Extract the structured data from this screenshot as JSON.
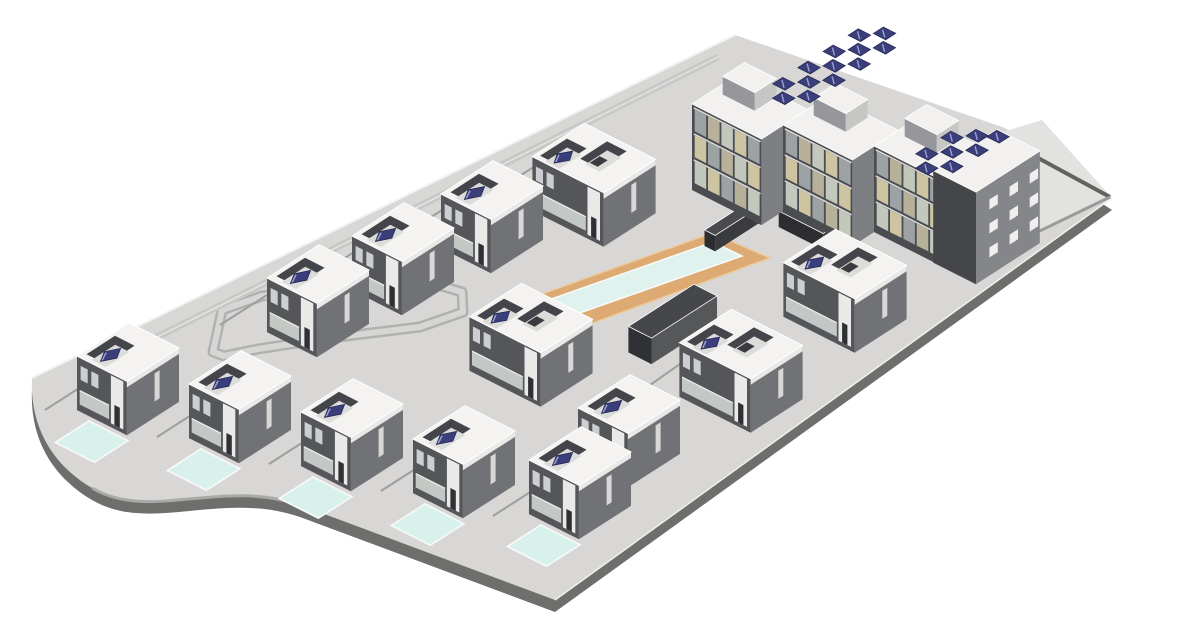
{
  "meta": {
    "title": "Axonometric BIM rendering of a residential development: rows of two-storey villas with private pools and rooftop solar terraces, a central communal swimming pool with timber deck, and a three-storey apartment complex with rooftop photovoltaic arrays",
    "width": 1200,
    "height": 640
  },
  "iso": {
    "u": [
      0.84,
      -0.54
    ],
    "v": [
      0.89,
      0.45
    ]
  },
  "palette": {
    "background": "#ffffff",
    "slabTop": "#d8d7d6",
    "slabShadow": "#6e6e6d",
    "slabEdgeLight": "#f2f2f1",
    "plaza": "#e2e2e1",
    "plazaParapetDark": "#62625f",
    "plazaParapetLight": "#9a9a99",
    "road": "#b1b1b0",
    "roadInner": "#d6d6d5",
    "curb": "#a9a9a8",
    "pathLight": "#c8c8c7",
    "pathCenter": "#e4e4e3",
    "lotLine": "#9e9e9d",
    "villaRoof": "#f4f3f1",
    "villaSW": "#55565a",
    "villaSE": "#717276",
    "villaWhite": "#eae9e7",
    "villaDoor": "#2e3034",
    "windowLight": "#ccced1",
    "balconyGlass": "#c3c8c5",
    "railLight": "#f0f0ee",
    "terraceWall": "#44454a",
    "terraceFloor": "#dcdcda",
    "terraceSlit": "#3a3b3f",
    "solar": "#3a3e7a",
    "solarEdge": "#242650",
    "solarStreak": "#9ba1d2",
    "deck": "#dcaa72",
    "deckEdge": "#ecca9b",
    "water": "#e0f2ee",
    "poolEdge": "#fafaf9",
    "frontPool": "#d9f1ec",
    "aptRoof": "#f2f1ef",
    "aptFrame": "#4b4c50",
    "aptSE": "#7e7f83",
    "pentSW": "#96979a",
    "pentSE": "#c6c6c4",
    "towerSW": "#45464a",
    "towerSE": "#85868a",
    "floorLine": "#dadad8",
    "parapetLine": "#c9c9c7",
    "courtTop": "#4a4b4e",
    "courtSW": "#2c2d30",
    "courtSE": "#3a3b3e",
    "phTop": "#46474a",
    "phSW": "#303134",
    "phSE": "#565759",
    "balconyCells": [
      "#c3c8bd",
      "#cdc5a2",
      "#9da3a5",
      "#b7b09a"
    ]
  },
  "site": {
    "outline": "M32,378 L735,35 L1005,128 L1112,198 L555,600 L300,505 C220,478 150,522 92,488 C48,462 30,422 32,378 Z",
    "shadow_dy": 12,
    "edge_highlight": [
      32,
      378,
      735,
      35
    ],
    "se_lip": [
      555,
      600,
      1112,
      198
    ]
  },
  "plaza": {
    "poly": [
      [
        950,
        148
      ],
      [
        1042,
        120
      ],
      [
        1112,
        198
      ],
      [
        1015,
        245
      ]
    ],
    "parapet_dark": [
      [
        1005,
        140
      ],
      [
        1110,
        197
      ]
    ],
    "parapet_light": [
      [
        1110,
        197
      ],
      [
        1015,
        243
      ]
    ]
  },
  "roads": {
    "loop": [
      [
        213,
        352
      ],
      [
        222,
        310
      ],
      [
        262,
        296
      ],
      [
        330,
        289
      ],
      [
        428,
        282
      ],
      [
        462,
        292
      ],
      [
        463,
        312
      ],
      [
        420,
        327
      ],
      [
        330,
        338
      ],
      [
        258,
        349
      ],
      [
        224,
        356
      ]
    ],
    "top_path": [
      95,
      368,
      718,
      57
    ],
    "curve_curb": "M300,505 C220,478 150,522 92,488",
    "dividers": [
      [
        140,
        349,
        45,
        410
      ],
      [
        252,
        376,
        157,
        437
      ],
      [
        364,
        403,
        269,
        464
      ],
      [
        476,
        430,
        381,
        491
      ],
      [
        588,
        455,
        493,
        516
      ],
      [
        275,
        290,
        220,
        325
      ],
      [
        362,
        247,
        307,
        282
      ],
      [
        450,
        205,
        395,
        240
      ],
      [
        540,
        163,
        485,
        198
      ],
      [
        598,
        418,
        545,
        452
      ],
      [
        700,
        350,
        650,
        385
      ]
    ]
  },
  "pool": {
    "deck": [
      [
        475,
        318
      ],
      [
        712,
        233
      ],
      [
        770,
        258
      ],
      [
        533,
        345
      ]
    ],
    "water": [
      [
        503,
        316
      ],
      [
        713,
        242
      ],
      [
        742,
        256
      ],
      [
        531,
        330
      ]
    ]
  },
  "pool_house": {
    "o": [
      676,
      334
    ],
    "u": [
      -44,
      34
    ],
    "v": [
      -12,
      14
    ],
    "h": 26
  },
  "court_walls": [
    {
      "o": [
        756,
        219
      ],
      "u": [
        -55,
        55
      ],
      "v": [
        -6,
        6
      ],
      "h": 16
    },
    {
      "o": [
        806,
        235
      ],
      "u": [
        -6,
        6
      ],
      "v": [
        -25,
        25
      ],
      "h": 16
    }
  ],
  "apartments": {
    "modules": [
      [
        692,
        190
      ],
      [
        783,
        211
      ],
      [
        874,
        232
      ]
    ],
    "mod_u": [
      0,
      55
    ],
    "mod_v": [
      0,
      78
    ],
    "mod_h": 86,
    "penthouse": {
      "u": [
        26,
        52
      ],
      "v": [
        10,
        46
      ],
      "z": [
        86,
        104
      ]
    },
    "balcony_floors": [
      [
        8,
        30
      ],
      [
        34,
        56
      ],
      [
        60,
        82
      ]
    ],
    "balcony_bays": {
      "start": 3,
      "width": 13,
      "gap": 2,
      "count": 5
    },
    "tower": {
      "o": [
        945,
        255
      ],
      "u": [
        -14,
        62
      ],
      "v": [
        0,
        48
      ],
      "h": 92
    },
    "tower_windows_z": [
      [
        18,
        28
      ],
      [
        42,
        52
      ],
      [
        66,
        76
      ]
    ],
    "tower_windows_u": [
      [
        2,
        12
      ],
      [
        26,
        36
      ],
      [
        50,
        60
      ]
    ],
    "solar": {
      "du": 12,
      "dv": 14,
      "clusters": [
        {
          "anchor": [
            760,
            92
          ],
          "offsets": [
            [
              0,
              14
            ],
            [
              15,
              0
            ],
            [
              15,
              28
            ],
            [
              30,
              14
            ],
            [
              45,
              0
            ],
            [
              45,
              28
            ],
            [
              60,
              14
            ],
            [
              75,
              0
            ],
            [
              75,
              28
            ],
            [
              90,
              14
            ],
            [
              105,
              0
            ],
            [
              105,
              28
            ],
            [
              120,
              14
            ]
          ]
        },
        {
          "anchor": [
            903,
            162
          ],
          "offsets": [
            [
              0,
              14
            ],
            [
              15,
              0
            ],
            [
              15,
              28
            ],
            [
              30,
              14
            ],
            [
              45,
              0
            ],
            [
              45,
              28
            ],
            [
              60,
              14
            ],
            [
              70,
              28
            ]
          ]
        }
      ]
    }
  },
  "villa_geom": {
    "a": 31,
    "bS": 28,
    "bD": 40,
    "h": 54,
    "recessS": [
      {
        "u": [
          -24,
          10
        ],
        "v": [
          -24,
          -2
        ],
        "panel": true
      }
    ],
    "recessD": [
      {
        "u": [
          -26,
          6
        ],
        "v": [
          -36,
          -14
        ],
        "panel": true
      },
      {
        "u": [
          -8,
          24
        ],
        "v": [
          -8,
          14
        ],
        "panel": false
      }
    ],
    "front_pool": [
      [
        -76,
        -10
      ],
      [
        -36,
        -10
      ],
      [
        -36,
        34
      ],
      [
        -76,
        34
      ]
    ]
  },
  "villas": [
    {
      "cx": 594,
      "cy": 212,
      "type": "d",
      "pool": false
    },
    {
      "cx": 492,
      "cy": 244,
      "type": "s",
      "pool": false
    },
    {
      "cx": 403,
      "cy": 286,
      "type": "s",
      "pool": false
    },
    {
      "cx": 845,
      "cy": 318,
      "type": "d",
      "pool": false
    },
    {
      "cx": 318,
      "cy": 328,
      "type": "s",
      "pool": false
    },
    {
      "cx": 531,
      "cy": 372,
      "type": "d",
      "pool": false
    },
    {
      "cx": 741,
      "cy": 398,
      "type": "d",
      "pool": false
    },
    {
      "cx": 128,
      "cy": 406,
      "type": "s",
      "pool": true
    },
    {
      "cx": 240,
      "cy": 434,
      "type": "s",
      "pool": true
    },
    {
      "cx": 629,
      "cy": 458,
      "type": "s",
      "pool": false
    },
    {
      "cx": 352,
      "cy": 462,
      "type": "s",
      "pool": true
    },
    {
      "cx": 464,
      "cy": 489,
      "type": "s",
      "pool": true
    },
    {
      "cx": 580,
      "cy": 510,
      "type": "s",
      "pool": true
    }
  ]
}
